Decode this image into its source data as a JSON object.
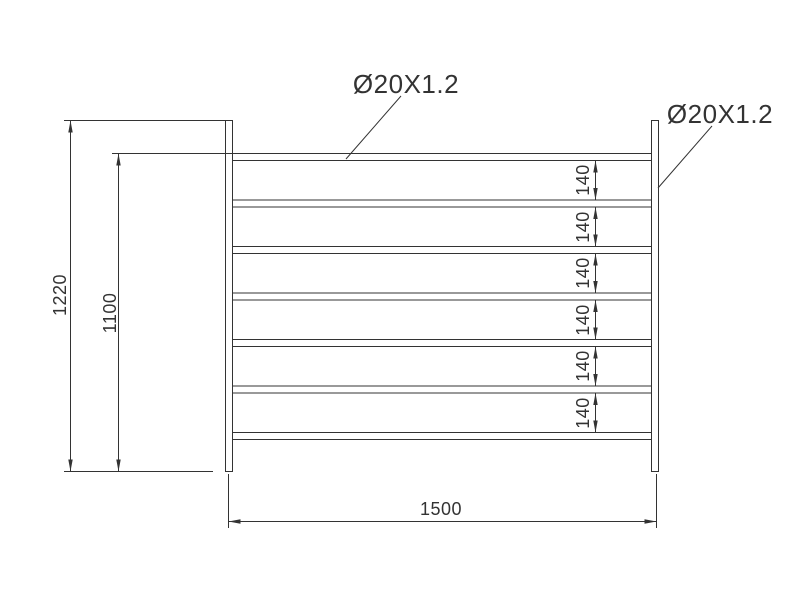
{
  "diagram": {
    "kind": "technical-drawing",
    "background_color": "#ffffff",
    "line_color": "#333333",
    "annotations": {
      "rail_spec": "Ø20X1.2",
      "post_spec": "Ø20X1.2"
    },
    "dimensions": {
      "overall_height": "1220",
      "rail_zone_height": "1100",
      "overall_width": "1500",
      "rail_gaps": [
        "140",
        "140",
        "140",
        "140",
        "140",
        "140"
      ]
    },
    "structure": {
      "post_count": 2,
      "rail_count": 7
    }
  }
}
